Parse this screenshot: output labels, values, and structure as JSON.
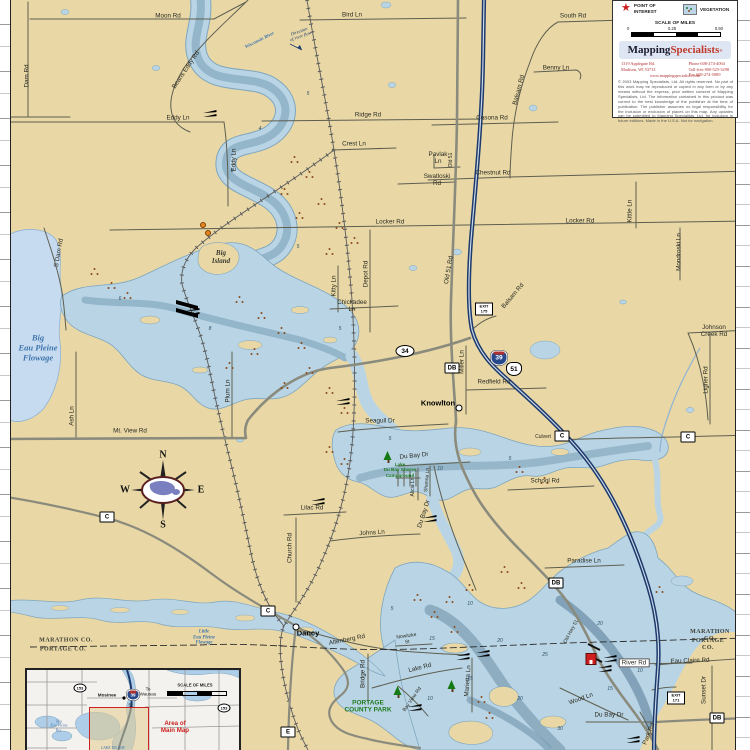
{
  "colors": {
    "land": "#e9d8a6",
    "water_shallow": "#b9d5e5",
    "water_flat": "#c6dbf0",
    "water_mid": "#93b6ca",
    "water_deep": "#8aa9bd",
    "shore": "#7fa6bd",
    "road_minor": "#5e5e50",
    "road_major": "#8b8b7d",
    "interstate_blue": "#1c3a6b",
    "rail": "#5a5a5a",
    "vegetation": "#8a4a1c",
    "park_green": "#1e7a1e",
    "water_label_blue": "#3f74ad",
    "accent_red": "#cc2222"
  },
  "legend": {
    "point_of_interest": "POINT OF\nINTEREST",
    "vegetation": "VEGETATION",
    "scale_title": "SCALE OF MILES",
    "scale_ticks": [
      "0",
      "0.25",
      "0.50"
    ],
    "logo_part1": "Mapping",
    "logo_part2": "Specialists",
    "logo_reg": "®",
    "address_line1": "1319 Applegate Rd.",
    "address_line2": "Madison, WI 53713",
    "phone": "Phone   608-274-4004",
    "tollfree": "Toll-free 800-525-3298",
    "fax": "Fax        608-274-5089",
    "website": "www.mappingspecialists.com",
    "copyright": "© 2003 Mapping Specialists, Ltd. All rights reserved. No part of this work may be reproduced or copied in any form or by any means without the express, prior written consent of Mapping Specialists, Ltd. The information contained in this product was correct to the best knowledge of the publisher at the time of publication. The publisher assumes no legal responsibility for the inclusion or exclusion of places on this map. Any updates can be submitted to Mapping Specialists, Ltd. for inclusion in future editions. Made in the U.S.A. Not for navigation."
  },
  "inset": {
    "labels": [
      {
        "id": "inset-scale-title",
        "t": "SCALE OF MILES",
        "x": 168,
        "y": 16,
        "c": "title"
      },
      {
        "id": "inset-mosinee",
        "t": "Mosinee",
        "x": 80,
        "y": 25,
        "c": "bold"
      },
      {
        "id": "inset-to-wausau",
        "t": "To\nWausau",
        "x": 121,
        "y": 22,
        "c": ""
      },
      {
        "id": "inset-hwy51",
        "t": "51",
        "x": 104,
        "y": 35,
        "c": ""
      },
      {
        "id": "inset-area-label",
        "t": "Area of\nMain Map",
        "x": 148,
        "y": 57,
        "c": "red"
      },
      {
        "id": "inset-big-eau-pleine-res",
        "t": "Big\nEau Pleine\nRes.",
        "x": 32,
        "y": 56,
        "c": "blue"
      },
      {
        "id": "inset-lake-du-bay",
        "t": "LAKE DU BAY",
        "x": 86,
        "y": 78,
        "c": "blue"
      },
      {
        "id": "inset-hwy153-west",
        "t": "153",
        "x": 53,
        "y": 18,
        "c": "oval"
      },
      {
        "id": "inset-hwy153-east",
        "t": "153",
        "x": 197,
        "y": 38,
        "c": "oval"
      },
      {
        "id": "inset-i39",
        "t": "39",
        "x": 106,
        "y": 25,
        "c": "ishield"
      }
    ]
  },
  "map": {
    "labels": [
      {
        "id": "moon-rd",
        "t": "Moon Rd",
        "x": 168,
        "y": 16,
        "r": 0,
        "c": "road"
      },
      {
        "id": "bird-ln",
        "t": "Bird Ln",
        "x": 352,
        "y": 15,
        "r": 0,
        "c": "road"
      },
      {
        "id": "south-rd",
        "t": "South Rd",
        "x": 573,
        "y": 16,
        "r": 0,
        "c": "road"
      },
      {
        "id": "benny-ln",
        "t": "Benny Ln",
        "x": 556,
        "y": 68,
        "r": 0,
        "c": "road"
      },
      {
        "id": "balsam-rd-n",
        "t": "Balsam Rd",
        "x": 519,
        "y": 90,
        "r": -75,
        "c": "road"
      },
      {
        "id": "dam-rd",
        "t": "Dam Rd",
        "x": 27,
        "y": 76,
        "r": -90,
        "c": "road"
      },
      {
        "id": "beans-eddy-rd",
        "t": "Beans Eddy Rd",
        "x": 186,
        "y": 70,
        "r": -56,
        "c": "road"
      },
      {
        "id": "eddy-ln",
        "t": "Eddy Ln",
        "x": 178,
        "y": 118,
        "r": 0,
        "c": "road"
      },
      {
        "id": "eddy-ln-v",
        "t": "Eddy Ln",
        "x": 234,
        "y": 160,
        "r": -90,
        "c": "road"
      },
      {
        "id": "ridge-rd",
        "t": "Ridge Rd",
        "x": 368,
        "y": 115,
        "r": 0,
        "c": "road"
      },
      {
        "id": "crest-ln",
        "t": "Crest Ln",
        "x": 354,
        "y": 144,
        "r": 0,
        "c": "road"
      },
      {
        "id": "cesona-rd",
        "t": "Cesona Rd",
        "x": 492,
        "y": 118,
        "r": 0,
        "c": "road"
      },
      {
        "id": "pavlak-ln",
        "t": "Pavlak\nLn",
        "x": 438,
        "y": 158,
        "r": 0,
        "c": "road"
      },
      {
        "id": "old-51-n",
        "t": "Old 51",
        "x": 452,
        "y": 160,
        "r": -90,
        "c": "tiny"
      },
      {
        "id": "swatloski-rd",
        "t": "Swatloski\nRd",
        "x": 437,
        "y": 180,
        "r": 0,
        "c": "road"
      },
      {
        "id": "chestnut-rd",
        "t": "Chestnut Rd",
        "x": 493,
        "y": 173,
        "r": 0,
        "c": "road"
      },
      {
        "id": "locker-rd-w",
        "t": "Locker Rd",
        "x": 390,
        "y": 222,
        "r": 0,
        "c": "road"
      },
      {
        "id": "locker-rd-e",
        "t": "Locker Rd",
        "x": 580,
        "y": 221,
        "r": 0,
        "c": "road"
      },
      {
        "id": "kittle-ln",
        "t": "Kittle Ln",
        "x": 630,
        "y": 211,
        "r": -90,
        "c": "road"
      },
      {
        "id": "mondroski-ln",
        "t": "Mondroski Ln",
        "x": 679,
        "y": 252,
        "r": -90,
        "c": "road"
      },
      {
        "id": "johnson-creek-rd",
        "t": "Johnson\nCreek Rd",
        "x": 714,
        "y": 331,
        "r": 0,
        "c": "road"
      },
      {
        "id": "ligner-rd",
        "t": "Ligner Rd",
        "x": 706,
        "y": 380,
        "r": -90,
        "c": "road"
      },
      {
        "id": "depot-rd",
        "t": "Depot Rd",
        "x": 366,
        "y": 274,
        "r": -90,
        "c": "road"
      },
      {
        "id": "kitty-ln",
        "t": "Kitty Ln",
        "x": 334,
        "y": 286,
        "r": -90,
        "c": "road"
      },
      {
        "id": "chickadee-ln",
        "t": "Chickadee\nLn",
        "x": 352,
        "y": 306,
        "r": 0,
        "c": "road"
      },
      {
        "id": "old-51-rd",
        "t": "Old 51 Rd",
        "x": 449,
        "y": 270,
        "r": -80,
        "c": "road"
      },
      {
        "id": "balsam-rd-s",
        "t": "Balsam Rd",
        "x": 513,
        "y": 296,
        "r": -50,
        "c": "road"
      },
      {
        "id": "mt-view-rd",
        "t": "Mt. View Rd",
        "x": 130,
        "y": 431,
        "r": 0,
        "c": "road"
      },
      {
        "id": "s-dam-rd",
        "t": "S Dam Rd",
        "x": 59,
        "y": 253,
        "r": -80,
        "c": "road"
      },
      {
        "id": "ash-ln",
        "t": "Ash Ln",
        "x": 72,
        "y": 416,
        "r": -90,
        "c": "road"
      },
      {
        "id": "plum-ln",
        "t": "Plum Ln",
        "x": 228,
        "y": 391,
        "r": -90,
        "c": "road"
      },
      {
        "id": "seagull-dr",
        "t": "Seagull Dr",
        "x": 380,
        "y": 421,
        "r": 0,
        "c": "road"
      },
      {
        "id": "miller-ln",
        "t": "Miller Ln",
        "x": 462,
        "y": 362,
        "r": -90,
        "c": "road"
      },
      {
        "id": "redfield-rd",
        "t": "Redfield Rd",
        "x": 494,
        "y": 382,
        "r": 0,
        "c": "road"
      },
      {
        "id": "culvert",
        "t": "Culvert",
        "x": 543,
        "y": 438,
        "r": 0,
        "c": "tiny"
      },
      {
        "id": "school-rd",
        "t": "School Rd",
        "x": 545,
        "y": 481,
        "r": 0,
        "c": "road"
      },
      {
        "id": "paradise-ln",
        "t": "Paradise Ln",
        "x": 584,
        "y": 561,
        "r": 0,
        "c": "road"
      },
      {
        "id": "lilac-rd",
        "t": "Lilac Rd",
        "x": 312,
        "y": 508,
        "r": 0,
        "c": "road"
      },
      {
        "id": "church-rd",
        "t": "Church Rd",
        "x": 290,
        "y": 548,
        "r": -90,
        "c": "road"
      },
      {
        "id": "johns-ln",
        "t": "Johns Ln",
        "x": 372,
        "y": 533,
        "r": -4,
        "c": "road"
      },
      {
        "id": "du-bay-dr-n",
        "t": "Du Bay Dr",
        "x": 414,
        "y": 456,
        "r": -6,
        "c": "road"
      },
      {
        "id": "alicia-ln",
        "t": "Alicia Ln",
        "x": 414,
        "y": 487,
        "r": -90,
        "c": "tiny"
      },
      {
        "id": "shanna-ln",
        "t": "Shanna Ln",
        "x": 428,
        "y": 480,
        "r": -85,
        "c": "tiny"
      },
      {
        "id": "du-bay-dr-mid",
        "t": "Du Bay Dr",
        "x": 424,
        "y": 514,
        "r": -72,
        "c": "road"
      },
      {
        "id": "old-hwy-51",
        "t": "Old Hwy 51",
        "x": 572,
        "y": 632,
        "r": -62,
        "c": "tiny"
      },
      {
        "id": "altenberg-rd",
        "t": "Altenberg Rd",
        "x": 347,
        "y": 640,
        "r": -11,
        "c": "road"
      },
      {
        "id": "nowitzke-st",
        "t": "Nowitzke\nSt",
        "x": 407,
        "y": 640,
        "r": -8,
        "c": "tiny"
      },
      {
        "id": "bridge-rd",
        "t": "Bridge Rd",
        "x": 363,
        "y": 674,
        "r": -90,
        "c": "road"
      },
      {
        "id": "lake-rd",
        "t": "Lake Rd",
        "x": 420,
        "y": 668,
        "r": -14,
        "c": "road"
      },
      {
        "id": "marietta-ln",
        "t": "Marietta Ln",
        "x": 468,
        "y": 681,
        "r": -86,
        "c": "road"
      },
      {
        "id": "bay-view-rd",
        "t": "Bay View Rd",
        "x": 413,
        "y": 700,
        "r": -55,
        "c": "tiny"
      },
      {
        "id": "wood-ln",
        "t": "Wood Ln",
        "x": 581,
        "y": 699,
        "r": -20,
        "c": "road"
      },
      {
        "id": "du-bay-dr-s",
        "t": "Du Bay Dr",
        "x": 609,
        "y": 715,
        "r": 0,
        "c": "road"
      },
      {
        "id": "river-rd",
        "t": "River Rd",
        "x": 634,
        "y": 663,
        "r": 0,
        "c": "road boxed"
      },
      {
        "id": "eau-claire-rd",
        "t": "Eau Claire Rd",
        "x": 690,
        "y": 661,
        "r": -2,
        "c": "road"
      },
      {
        "id": "sunset-dr",
        "t": "Sunset Dr",
        "x": 704,
        "y": 690,
        "r": -90,
        "c": "road"
      },
      {
        "id": "park-rd",
        "t": "Park Rd",
        "x": 649,
        "y": 734,
        "r": -68,
        "c": "road"
      },
      {
        "id": "knowlton",
        "t": "Knowlton",
        "x": 438,
        "y": 404,
        "r": 0,
        "c": "town"
      },
      {
        "id": "dancy",
        "t": "Dancy",
        "x": 308,
        "y": 634,
        "r": 0,
        "c": "town"
      },
      {
        "id": "big-island",
        "t": "Big\nIsland",
        "x": 221,
        "y": 257,
        "r": 0,
        "c": "island"
      },
      {
        "id": "big-eau-pleine-flowage",
        "t": "Big\nEau Pleine\nFlowage",
        "x": 38,
        "y": 348,
        "r": 0,
        "c": "water"
      },
      {
        "id": "little-eau-pleine-flowage",
        "t": "Little\nEau Pleine\nFlowage",
        "x": 204,
        "y": 638,
        "r": 0,
        "c": "watersm"
      },
      {
        "id": "wisconsin-river",
        "t": "Wisconsin River",
        "x": 260,
        "y": 41,
        "r": -27,
        "c": "watersm"
      },
      {
        "id": "direction-of-flow",
        "t": "Direction\nof river flow",
        "x": 300,
        "y": 34,
        "r": -20,
        "c": "note"
      },
      {
        "id": "marathon-co-left",
        "t": "MARATHON CO.",
        "x": 66,
        "y": 641,
        "r": 0,
        "c": "county"
      },
      {
        "id": "portage-co-left",
        "t": "PORTAGE CO.",
        "x": 63,
        "y": 650,
        "r": 0,
        "c": "county"
      },
      {
        "id": "marathon-co-right",
        "t": "MARATHON CO.",
        "x": 710,
        "y": 636,
        "r": 0,
        "c": "county"
      },
      {
        "id": "portage-co-right",
        "t": "PORTAGE CO.",
        "x": 708,
        "y": 645,
        "r": 0,
        "c": "county"
      },
      {
        "id": "portage-county-park",
        "t": "PORTAGE\nCOUNTY PARK",
        "x": 368,
        "y": 707,
        "r": 0,
        "c": "park"
      },
      {
        "id": "lake-du-bay-shores-campground",
        "t": "Lake\nDu Bay Shores\nCampground",
        "x": 400,
        "y": 470,
        "r": 0,
        "c": "parksm"
      },
      {
        "id": "compass-n",
        "t": "N",
        "x": 163,
        "y": 455,
        "r": 0,
        "c": "compass"
      },
      {
        "id": "compass-s",
        "t": "S",
        "x": 163,
        "y": 525,
        "r": 0,
        "c": "compass"
      },
      {
        "id": "compass-w",
        "t": "W",
        "x": 125,
        "y": 490,
        "r": 0,
        "c": "compass"
      },
      {
        "id": "compass-e",
        "t": "E",
        "x": 201,
        "y": 490,
        "r": 0,
        "c": "compass"
      }
    ],
    "badges": [
      {
        "id": "hwy-34-shield",
        "ty": "oval",
        "t": "34",
        "x": 405,
        "y": 351
      },
      {
        "id": "i-39-shield",
        "ty": "interstate",
        "t": "39",
        "x": 499,
        "y": 358
      },
      {
        "id": "us-51-shield",
        "ty": "us",
        "t": "51",
        "x": 514,
        "y": 369
      },
      {
        "id": "cty-db-knowlton",
        "ty": "box",
        "t": "DB",
        "x": 452,
        "y": 368
      },
      {
        "id": "cty-db-bridge",
        "ty": "box",
        "t": "DB",
        "x": 556,
        "y": 583
      },
      {
        "id": "cty-db-south",
        "ty": "box",
        "t": "DB",
        "x": 717,
        "y": 718
      },
      {
        "id": "cty-c-west",
        "ty": "box",
        "t": "C",
        "x": 107,
        "y": 517
      },
      {
        "id": "cty-c-dancy",
        "ty": "box",
        "t": "C",
        "x": 268,
        "y": 611
      },
      {
        "id": "cty-c-culvert",
        "ty": "box",
        "t": "C",
        "x": 562,
        "y": 436
      },
      {
        "id": "cty-c-east",
        "ty": "box",
        "t": "C",
        "x": 688,
        "y": 437
      },
      {
        "id": "cty-e",
        "ty": "box",
        "t": "E",
        "x": 288,
        "y": 732
      },
      {
        "id": "exit-175",
        "ty": "exit",
        "t": "EXIT\n175",
        "x": 484,
        "y": 309
      },
      {
        "id": "exit-171",
        "ty": "exit",
        "t": "EXIT\n171",
        "x": 676,
        "y": 698
      }
    ],
    "town_dots": [
      {
        "id": "knowlton-dot",
        "x": 459,
        "y": 408
      },
      {
        "id": "dancy-dot",
        "x": 296,
        "y": 627
      }
    ],
    "boat_landings": [
      {
        "x": 210,
        "y": 114
      },
      {
        "x": 193,
        "y": 312
      },
      {
        "x": 343,
        "y": 402
      },
      {
        "x": 318,
        "y": 502
      },
      {
        "x": 430,
        "y": 519
      },
      {
        "x": 483,
        "y": 654
      },
      {
        "x": 463,
        "y": 657
      },
      {
        "x": 610,
        "y": 659
      },
      {
        "x": 605,
        "y": 669
      },
      {
        "x": 415,
        "y": 708
      },
      {
        "x": 633,
        "y": 740
      }
    ],
    "poi_buildings": [
      {
        "id": "poi-building-bridge",
        "x": 591,
        "y": 659
      }
    ],
    "trees": [
      {
        "x": 388,
        "y": 462
      },
      {
        "x": 398,
        "y": 697
      },
      {
        "x": 452,
        "y": 691
      }
    ],
    "orange_markers": [
      {
        "x": 203,
        "y": 225
      },
      {
        "x": 208,
        "y": 233
      }
    ],
    "vegetation_clusters": [
      {
        "x": 295,
        "y": 160
      },
      {
        "x": 310,
        "y": 175
      },
      {
        "x": 285,
        "y": 192
      },
      {
        "x": 322,
        "y": 202
      },
      {
        "x": 300,
        "y": 216
      },
      {
        "x": 340,
        "y": 226
      },
      {
        "x": 355,
        "y": 241
      },
      {
        "x": 330,
        "y": 252
      },
      {
        "x": 95,
        "y": 272
      },
      {
        "x": 112,
        "y": 286
      },
      {
        "x": 128,
        "y": 296
      },
      {
        "x": 240,
        "y": 300
      },
      {
        "x": 262,
        "y": 316
      },
      {
        "x": 282,
        "y": 331
      },
      {
        "x": 302,
        "y": 346
      },
      {
        "x": 255,
        "y": 352
      },
      {
        "x": 230,
        "y": 366
      },
      {
        "x": 310,
        "y": 371
      },
      {
        "x": 330,
        "y": 391
      },
      {
        "x": 345,
        "y": 411
      },
      {
        "x": 285,
        "y": 386
      },
      {
        "x": 330,
        "y": 450
      },
      {
        "x": 345,
        "y": 462
      },
      {
        "x": 520,
        "y": 470
      },
      {
        "x": 545,
        "y": 481
      },
      {
        "x": 505,
        "y": 570
      },
      {
        "x": 522,
        "y": 586
      },
      {
        "x": 450,
        "y": 600
      },
      {
        "x": 470,
        "y": 588
      },
      {
        "x": 435,
        "y": 615
      },
      {
        "x": 660,
        "y": 590
      },
      {
        "x": 482,
        "y": 700
      },
      {
        "x": 490,
        "y": 716
      },
      {
        "x": 455,
        "y": 630
      },
      {
        "x": 418,
        "y": 598
      }
    ],
    "depths": [
      {
        "t": "5",
        "x": 308,
        "y": 95
      },
      {
        "t": "4",
        "x": 260,
        "y": 130
      },
      {
        "t": "8",
        "x": 232,
        "y": 172
      },
      {
        "t": "5",
        "x": 298,
        "y": 248
      },
      {
        "t": "6",
        "x": 120,
        "y": 300
      },
      {
        "t": "8",
        "x": 210,
        "y": 330
      },
      {
        "t": "5",
        "x": 340,
        "y": 330
      },
      {
        "t": "5",
        "x": 390,
        "y": 440
      },
      {
        "t": "10",
        "x": 440,
        "y": 470
      },
      {
        "t": "5",
        "x": 510,
        "y": 460
      },
      {
        "t": "10",
        "x": 470,
        "y": 605
      },
      {
        "t": "15",
        "x": 432,
        "y": 640
      },
      {
        "t": "20",
        "x": 500,
        "y": 642
      },
      {
        "t": "25",
        "x": 545,
        "y": 656
      },
      {
        "t": "15",
        "x": 470,
        "y": 680
      },
      {
        "t": "20",
        "x": 520,
        "y": 700
      },
      {
        "t": "30",
        "x": 560,
        "y": 730
      },
      {
        "t": "15",
        "x": 610,
        "y": 690
      },
      {
        "t": "10",
        "x": 640,
        "y": 672
      },
      {
        "t": "20",
        "x": 600,
        "y": 625
      },
      {
        "t": "10",
        "x": 430,
        "y": 700
      },
      {
        "t": "5",
        "x": 392,
        "y": 610
      }
    ]
  }
}
